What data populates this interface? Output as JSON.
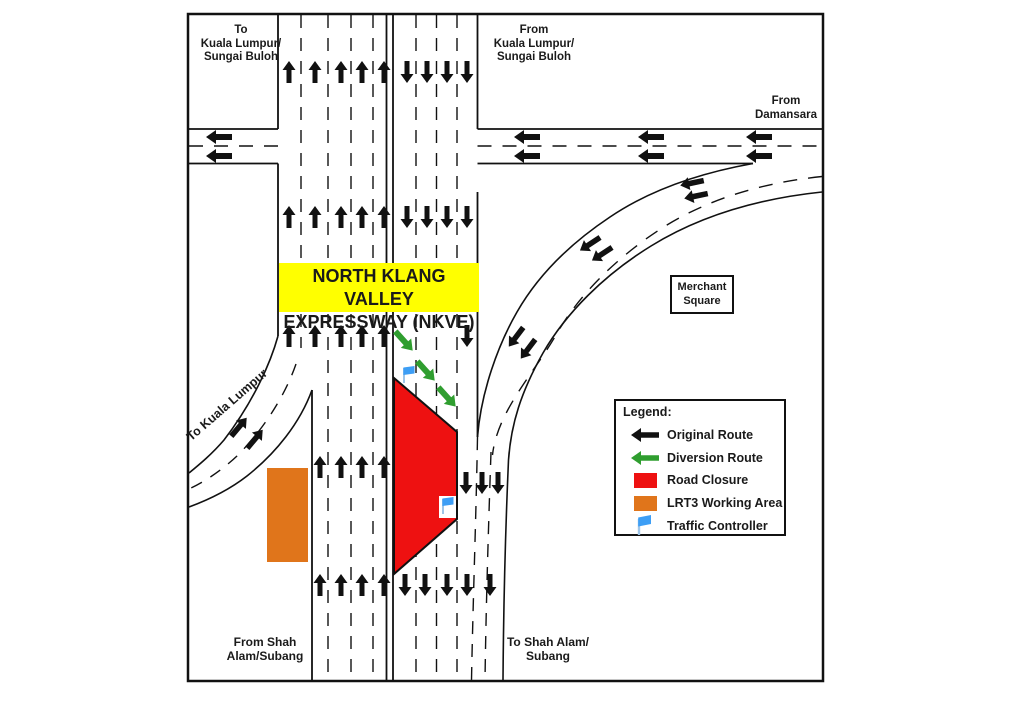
{
  "labels": {
    "to_kl_sb": {
      "l1": "To",
      "l2": "Kuala Lumpur/",
      "l3": "Sungai Buloh"
    },
    "from_kl_sb": {
      "l1": "From",
      "l2": "Kuala Lumpur/",
      "l3": "Sungai Buloh"
    },
    "from_damansara": {
      "l1": "From",
      "l2": "Damansara"
    },
    "nkve": {
      "l1": "NORTH KLANG VALLEY",
      "l2": "EXPRESSWAY (NKVE)"
    },
    "merchant": {
      "l1": "Merchant",
      "l2": "Square"
    },
    "to_kl_ramp": "To Kuala Lumpur",
    "from_shah": {
      "l1": "From Shah",
      "l2": "Alam/Subang"
    },
    "to_shah": {
      "l1": "To Shah Alam/",
      "l2": "Subang"
    }
  },
  "legend": {
    "title": "Legend:",
    "items": [
      {
        "label": "Original Route",
        "icon": "black-arrow"
      },
      {
        "label": "Diversion Route",
        "icon": "green-arrow"
      },
      {
        "label": "Road Closure",
        "icon": "red-swatch"
      },
      {
        "label": "LRT3 Working Area",
        "icon": "orange-swatch"
      },
      {
        "label": "Traffic Controller",
        "icon": "blue-flag"
      }
    ]
  },
  "colors": {
    "original_route": "#111111",
    "diversion_route": "#2F9E2F",
    "road_closure": "#EE1111",
    "lrt3_area": "#E0751B",
    "traffic_controller": "#3D9EF5",
    "flag_pole": "#9FC5E8",
    "highlight": "#FFFF00",
    "road_line": "#111111"
  },
  "arrows": {
    "black_up": [
      [
        289,
        72
      ],
      [
        315,
        72
      ],
      [
        341,
        72
      ],
      [
        362,
        72
      ],
      [
        384,
        72
      ],
      [
        289,
        217
      ],
      [
        315,
        217
      ],
      [
        341,
        217
      ],
      [
        362,
        217
      ],
      [
        384,
        217
      ],
      [
        289,
        336
      ],
      [
        315,
        336
      ],
      [
        341,
        336
      ],
      [
        362,
        336
      ],
      [
        384,
        336
      ],
      [
        320,
        467
      ],
      [
        341,
        467
      ],
      [
        362,
        467
      ],
      [
        384,
        467
      ],
      [
        320,
        585
      ],
      [
        341,
        585
      ],
      [
        362,
        585
      ],
      [
        384,
        585
      ]
    ],
    "black_down": [
      [
        407,
        72
      ],
      [
        427,
        72
      ],
      [
        447,
        72
      ],
      [
        467,
        72
      ],
      [
        407,
        217
      ],
      [
        427,
        217
      ],
      [
        447,
        217
      ],
      [
        467,
        217
      ],
      [
        467,
        336
      ],
      [
        466,
        483
      ],
      [
        482,
        483
      ],
      [
        498,
        483
      ],
      [
        405,
        585
      ],
      [
        425,
        585
      ],
      [
        447,
        585
      ],
      [
        467,
        585
      ],
      [
        490,
        585
      ]
    ],
    "h_left": [
      [
        219,
        137
      ],
      [
        219,
        156
      ],
      [
        527,
        137
      ],
      [
        527,
        156
      ],
      [
        651,
        137
      ],
      [
        651,
        156
      ],
      [
        759,
        137
      ],
      [
        759,
        156
      ]
    ],
    "curve": [
      [
        692,
        183,
        258
      ],
      [
        696,
        196,
        258
      ],
      [
        590,
        244,
        237
      ],
      [
        602,
        254,
        237
      ],
      [
        516,
        337,
        217
      ],
      [
        528,
        349,
        217
      ]
    ],
    "ramp": [
      [
        239,
        427,
        40
      ],
      [
        255,
        439,
        40
      ]
    ],
    "green": [
      [
        404,
        341,
        138
      ],
      [
        426,
        371,
        138
      ],
      [
        447,
        397,
        138
      ]
    ]
  },
  "flags": [
    {
      "x": 402,
      "y": 366,
      "bg": false
    },
    {
      "x": 441,
      "y": 497,
      "bg": true
    }
  ]
}
